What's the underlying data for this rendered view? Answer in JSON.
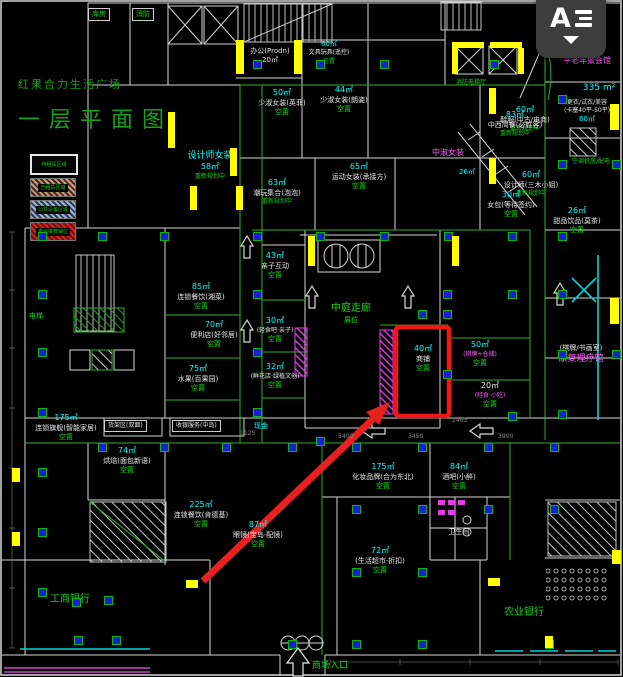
{
  "title": {
    "line1": "红果合力生活广场",
    "line2": "一层平面图"
  },
  "legend": {
    "items": [
      {
        "label": "待租赁区域",
        "swatch": "plain"
      },
      {
        "label": "已租赁区域",
        "swatch": "tan"
      },
      {
        "label": "公共设备区域",
        "swatch": "blue"
      },
      {
        "label": "重点推荐铺位",
        "swatch": "red"
      }
    ]
  },
  "watermark": {
    "label": "A",
    "caret": "dropdown"
  },
  "entrance": {
    "label": "商场入口"
  },
  "highlight": {
    "area": "40㎡",
    "name": "商铺",
    "status": "空置"
  },
  "colors": {
    "background": "#000000",
    "walls": "#dcdcdc",
    "rooms_green": "#2fae2f",
    "area_text": "#00ffff",
    "status_text": "#16d216",
    "special_text": "#ff5cff",
    "columns": "#1d1dd8",
    "wall_fill": "#ffff00",
    "highlight_red": "#f21616"
  },
  "plan": {
    "labels": [
      {
        "x": 88,
        "y": 8,
        "box": true,
        "lines": [
          {
            "t": "库房",
            "c": "gr",
            "s": 7
          }
        ]
      },
      {
        "x": 132,
        "y": 8,
        "box": true,
        "lines": [
          {
            "t": "消防",
            "c": "gr",
            "s": 7
          }
        ]
      },
      {
        "x": 240,
        "y": 47,
        "w": 60,
        "lines": [
          {
            "t": "办公(Prodn)",
            "c": "wh",
            "s": 7
          },
          {
            "t": "20㎡",
            "c": "wh",
            "s": 7
          }
        ]
      },
      {
        "x": 300,
        "y": 40,
        "w": 58,
        "lines": [
          {
            "t": "60㎡",
            "c": "cy",
            "s": 7
          },
          {
            "t": "文具玩具(遥控)",
            "c": "wh",
            "s": 6
          },
          {
            "t": "空置",
            "c": "gr",
            "s": 6
          }
        ]
      },
      {
        "x": 450,
        "y": 79,
        "w": 42,
        "lines": [
          {
            "t": "消防电梯厅",
            "c": "gr",
            "s": 6
          }
        ]
      },
      {
        "x": 540,
        "y": 22,
        "w": 72,
        "lines": [
          {
            "t": "75㎡ 设计师(预留)",
            "c": "wh",
            "s": 7
          }
        ]
      },
      {
        "x": 556,
        "y": 56,
        "w": 62,
        "lines": [
          {
            "t": "平老年聚会馆",
            "c": "mg",
            "s": 8
          }
        ]
      },
      {
        "x": 576,
        "y": 82,
        "w": 46,
        "lines": [
          {
            "t": "335 m²",
            "c": "cy",
            "s": 9
          }
        ]
      },
      {
        "x": 554,
        "y": 99,
        "w": 66,
        "lines": [
          {
            "t": "更衣/试衣/美容",
            "c": "wh",
            "s": 6
          },
          {
            "t": "(卡塞40平-50平)",
            "c": "wh",
            "s": 6
          },
          {
            "t": "60㎡",
            "c": "cy",
            "s": 7
          }
        ]
      },
      {
        "x": 562,
        "y": 158,
        "w": 58,
        "lines": [
          {
            "t": "空调机房/配电",
            "c": "gr",
            "s": 6
          }
        ]
      },
      {
        "x": 546,
        "y": 206,
        "w": 62,
        "lines": [
          {
            "t": "26㎡",
            "c": "cy",
            "s": 8
          },
          {
            "t": "甜品饮品(莫茶)",
            "c": "wh",
            "s": 7
          },
          {
            "t": "空置",
            "c": "gr",
            "s": 7
          }
        ]
      },
      {
        "x": 256,
        "y": 88,
        "w": 52,
        "lines": [
          {
            "t": "50㎡",
            "c": "cy",
            "s": 8
          },
          {
            "t": "少淑女装(英菲)",
            "c": "wh",
            "s": 7
          },
          {
            "t": "空置",
            "c": "gr",
            "s": 7
          }
        ]
      },
      {
        "x": 318,
        "y": 85,
        "w": 52,
        "lines": [
          {
            "t": "44㎡",
            "c": "cy",
            "s": 8
          },
          {
            "t": "少淑女装(朗姿)",
            "c": "wh",
            "s": 7
          },
          {
            "t": "空置",
            "c": "gr",
            "s": 7
          }
        ]
      },
      {
        "x": 494,
        "y": 105,
        "w": 62,
        "lines": [
          {
            "t": "60㎡",
            "c": "cy",
            "s": 8
          },
          {
            "t": "鞋服(中古/电商)",
            "c": "wh",
            "s": 7
          },
          {
            "t": "重新规划中",
            "c": "gr",
            "s": 6
          }
        ]
      },
      {
        "x": 246,
        "y": 178,
        "w": 62,
        "lines": [
          {
            "t": "63㎡",
            "c": "cy",
            "s": 8
          },
          {
            "t": "潮玩集合(泡泡)",
            "c": "wh",
            "s": 7
          },
          {
            "t": "重新规划中",
            "c": "gr",
            "s": 6
          }
        ]
      },
      {
        "x": 328,
        "y": 162,
        "w": 62,
        "lines": [
          {
            "t": "65㎡",
            "c": "cy",
            "s": 8
          },
          {
            "t": "运动女装(承接方)",
            "c": "wh",
            "s": 7
          },
          {
            "t": "空置",
            "c": "gr",
            "s": 7
          }
        ]
      },
      {
        "x": 496,
        "y": 170,
        "w": 70,
        "lines": [
          {
            "t": "60㎡",
            "c": "cy",
            "s": 8
          },
          {
            "t": "设计师(三木小姐)",
            "c": "wh",
            "s": 7
          },
          {
            "t": "重新规划中",
            "c": "gr",
            "s": 6
          }
        ]
      },
      {
        "x": 186,
        "y": 150,
        "w": 48,
        "lines": [
          {
            "t": "设计师女装",
            "c": "cy",
            "s": 9
          },
          {
            "t": "58㎡",
            "c": "cy",
            "s": 8
          },
          {
            "t": "重新规划中",
            "c": "gr",
            "s": 6
          }
        ]
      },
      {
        "x": 420,
        "y": 148,
        "w": 56,
        "lines": [
          {
            "t": "中淑女装",
            "c": "mg",
            "s": 8
          }
        ]
      },
      {
        "x": 452,
        "y": 168,
        "w": 30,
        "lines": [
          {
            "t": "26㎡",
            "c": "cy",
            "s": 7
          }
        ]
      },
      {
        "x": 480,
        "y": 190,
        "w": 62,
        "lines": [
          {
            "t": "30㎡",
            "c": "cy",
            "s": 8
          },
          {
            "t": "女包(等待签约)",
            "c": "wh",
            "s": 7
          },
          {
            "t": "空置",
            "c": "gr",
            "s": 7
          }
        ]
      },
      {
        "x": 484,
        "y": 110,
        "w": 62,
        "lines": [
          {
            "t": "83㎡",
            "c": "cy",
            "s": 8
          },
          {
            "t": "中西简餐(必胜客)",
            "c": "wh",
            "s": 7
          },
          {
            "t": "重新规划中",
            "c": "gr",
            "s": 6
          }
        ]
      },
      {
        "x": 252,
        "y": 251,
        "w": 46,
        "lines": [
          {
            "t": "43㎡",
            "c": "cy",
            "s": 8
          },
          {
            "t": "亲子互动",
            "c": "wh",
            "s": 7
          },
          {
            "t": "空置",
            "c": "gr",
            "s": 7
          }
        ]
      },
      {
        "x": 250,
        "y": 316,
        "w": 50,
        "lines": [
          {
            "t": "30㎡",
            "c": "cy",
            "s": 8
          },
          {
            "t": "(轻食吧·亲子)",
            "c": "wh",
            "s": 6
          },
          {
            "t": "空置",
            "c": "gr",
            "s": 7
          }
        ]
      },
      {
        "x": 246,
        "y": 362,
        "w": 58,
        "lines": [
          {
            "t": "32㎡",
            "c": "cy",
            "s": 8
          },
          {
            "t": "(鲜花店·绿植文创)",
            "c": "wh",
            "s": 6
          },
          {
            "t": "空置",
            "c": "gr",
            "s": 7
          }
        ]
      },
      {
        "x": 306,
        "y": 302,
        "w": 90,
        "lines": [
          {
            "t": "中庭走廊",
            "c": "gr",
            "s": 10
          },
          {
            "t": "展位",
            "c": "gr",
            "s": 7
          }
        ]
      },
      {
        "x": 400,
        "y": 344,
        "w": 46,
        "lines": [
          {
            "t": "40㎡",
            "c": "cy",
            "s": 8
          },
          {
            "t": "商铺",
            "c": "wh",
            "s": 7
          },
          {
            "t": "空置",
            "c": "gr",
            "s": 7
          }
        ]
      },
      {
        "x": 452,
        "y": 340,
        "w": 56,
        "lines": [
          {
            "t": "50㎡",
            "c": "cy",
            "s": 8
          },
          {
            "t": "(棋牌+仓储)",
            "c": "mg",
            "s": 6
          },
          {
            "t": "空置",
            "c": "gr",
            "s": 7
          }
        ]
      },
      {
        "x": 462,
        "y": 381,
        "w": 56,
        "lines": [
          {
            "t": "20㎡",
            "c": "wh",
            "s": 8
          },
          {
            "t": "(轻食·小吃)",
            "c": "mg",
            "s": 6
          },
          {
            "t": "空置",
            "c": "gr",
            "s": 7
          }
        ]
      },
      {
        "x": 544,
        "y": 344,
        "w": 74,
        "lines": [
          {
            "t": "(棋牌/书画室)",
            "c": "wh",
            "s": 7
          },
          {
            "t": "康复理疗馆",
            "c": "mg",
            "s": 9
          }
        ]
      },
      {
        "x": 166,
        "y": 282,
        "w": 70,
        "lines": [
          {
            "t": "85㎡",
            "c": "cy",
            "s": 8
          },
          {
            "t": "连锁餐饮(湘菜)",
            "c": "wh",
            "s": 7
          },
          {
            "t": "空置",
            "c": "gr",
            "s": 7
          }
        ]
      },
      {
        "x": 182,
        "y": 320,
        "w": 64,
        "lines": [
          {
            "t": "70㎡",
            "c": "cy",
            "s": 8
          },
          {
            "t": "便利店(好邻居)",
            "c": "wh",
            "s": 7
          },
          {
            "t": "空置",
            "c": "gr",
            "s": 7
          }
        ]
      },
      {
        "x": 168,
        "y": 364,
        "w": 60,
        "lines": [
          {
            "t": "75㎡",
            "c": "cy",
            "s": 8
          },
          {
            "t": "水果(百果园)",
            "c": "wh",
            "s": 7
          },
          {
            "t": "空置",
            "c": "gr",
            "s": 7
          }
        ]
      },
      {
        "x": 24,
        "y": 413,
        "w": 84,
        "lines": [
          {
            "t": "175㎡",
            "c": "cy",
            "s": 8
          },
          {
            "t": "连锁旗舰(智能家居)",
            "c": "wh",
            "s": 7
          },
          {
            "t": "空置",
            "c": "gr",
            "s": 7
          }
        ]
      },
      {
        "x": 20,
        "y": 312,
        "w": 32,
        "lines": [
          {
            "t": "电梯",
            "c": "gr",
            "s": 7
          }
        ]
      },
      {
        "x": 104,
        "y": 420,
        "box": true,
        "lines": [
          {
            "t": "货架区(双面)",
            "c": "wh",
            "s": 6
          }
        ]
      },
      {
        "x": 172,
        "y": 420,
        "box": true,
        "lines": [
          {
            "t": "收银服务(中岛)",
            "c": "wh",
            "s": 6
          }
        ]
      },
      {
        "x": 248,
        "y": 422,
        "w": 26,
        "lines": [
          {
            "t": "现金",
            "c": "cy",
            "s": 7
          }
        ]
      },
      {
        "x": 336,
        "y": 462,
        "w": 94,
        "lines": [
          {
            "t": "175㎡",
            "c": "cy",
            "s": 8
          },
          {
            "t": "化妆品牌(合为东北)",
            "c": "wh",
            "s": 7
          },
          {
            "t": "空置",
            "c": "gr",
            "s": 7
          }
        ]
      },
      {
        "x": 342,
        "y": 546,
        "w": 76,
        "lines": [
          {
            "t": "72㎡",
            "c": "cy",
            "s": 8
          },
          {
            "t": "(生活超市·折扣)",
            "c": "wh",
            "s": 7
          },
          {
            "t": "空置",
            "c": "gr",
            "s": 7
          }
        ]
      },
      {
        "x": 422,
        "y": 462,
        "w": 74,
        "lines": [
          {
            "t": "84㎡",
            "c": "cy",
            "s": 8
          },
          {
            "t": "酒吧(小醉)",
            "c": "wh",
            "s": 7
          },
          {
            "t": "空置",
            "c": "gr",
            "s": 7
          }
        ]
      },
      {
        "x": 438,
        "y": 528,
        "w": 42,
        "lines": [
          {
            "t": "卫生间",
            "c": "wh",
            "s": 7
          }
        ]
      },
      {
        "x": 96,
        "y": 446,
        "w": 62,
        "lines": [
          {
            "t": "74㎡",
            "c": "cy",
            "s": 8
          },
          {
            "t": "烘焙(面包新语)",
            "c": "wh",
            "s": 7
          },
          {
            "t": "空置",
            "c": "gr",
            "s": 7
          }
        ]
      },
      {
        "x": 164,
        "y": 500,
        "w": 74,
        "lines": [
          {
            "t": "225㎡",
            "c": "cy",
            "s": 8
          },
          {
            "t": "连锁餐饮(肯德基)",
            "c": "wh",
            "s": 7
          },
          {
            "t": "空置",
            "c": "gr",
            "s": 7
          }
        ]
      },
      {
        "x": 222,
        "y": 520,
        "w": 72,
        "lines": [
          {
            "t": "87㎡",
            "c": "cy",
            "s": 8
          },
          {
            "t": "眼镜(宝岛·配镜)",
            "c": "wh",
            "s": 7
          },
          {
            "t": "空置",
            "c": "gr",
            "s": 7
          }
        ]
      },
      {
        "x": 38,
        "y": 593,
        "w": 64,
        "lines": [
          {
            "t": "工商银行",
            "c": "gr",
            "s": 10
          }
        ]
      },
      {
        "x": 488,
        "y": 606,
        "w": 72,
        "lines": [
          {
            "t": "农业银行",
            "c": "gr",
            "s": 10
          }
        ]
      },
      {
        "x": 304,
        "y": 660,
        "w": 52,
        "lines": [
          {
            "t": "商场入口",
            "c": "gr",
            "s": 9
          }
        ]
      }
    ],
    "columns": [
      [
        253,
        60
      ],
      [
        316,
        60
      ],
      [
        380,
        60
      ],
      [
        490,
        60
      ],
      [
        253,
        232
      ],
      [
        316,
        232
      ],
      [
        380,
        232
      ],
      [
        444,
        232
      ],
      [
        508,
        232
      ],
      [
        253,
        290
      ],
      [
        253,
        348
      ],
      [
        253,
        408
      ],
      [
        443,
        290
      ],
      [
        443,
        310
      ],
      [
        443,
        370
      ],
      [
        508,
        290
      ],
      [
        508,
        412
      ],
      [
        558,
        95
      ],
      [
        558,
        160
      ],
      [
        558,
        232
      ],
      [
        558,
        290
      ],
      [
        558,
        350
      ],
      [
        558,
        410
      ],
      [
        612,
        160
      ],
      [
        612,
        350
      ],
      [
        38,
        232
      ],
      [
        38,
        290
      ],
      [
        38,
        348
      ],
      [
        38,
        408
      ],
      [
        38,
        468
      ],
      [
        38,
        528
      ],
      [
        38,
        588
      ],
      [
        98,
        232
      ],
      [
        160,
        232
      ],
      [
        98,
        443
      ],
      [
        160,
        443
      ],
      [
        222,
        443
      ],
      [
        288,
        443
      ],
      [
        352,
        443
      ],
      [
        418,
        443
      ],
      [
        484,
        443
      ],
      [
        550,
        443
      ],
      [
        352,
        505
      ],
      [
        418,
        505
      ],
      [
        484,
        505
      ],
      [
        550,
        505
      ],
      [
        352,
        568
      ],
      [
        418,
        568
      ],
      [
        72,
        598
      ],
      [
        104,
        596
      ],
      [
        74,
        636
      ],
      [
        112,
        636
      ],
      [
        288,
        640
      ],
      [
        352,
        640
      ],
      [
        418,
        640
      ],
      [
        545,
        640
      ],
      [
        418,
        310
      ],
      [
        316,
        437
      ]
    ],
    "yellow_marks": [
      [
        168,
        112,
        7,
        36
      ],
      [
        230,
        148,
        7,
        28
      ],
      [
        308,
        236,
        7,
        30
      ],
      [
        452,
        236,
        7,
        30
      ],
      [
        489,
        88,
        7,
        26
      ],
      [
        489,
        158,
        7,
        26
      ],
      [
        610,
        104,
        9,
        26
      ],
      [
        610,
        298,
        9,
        26
      ],
      [
        236,
        40,
        8,
        34
      ],
      [
        294,
        40,
        8,
        34
      ],
      [
        452,
        42,
        32,
        6
      ],
      [
        452,
        48,
        6,
        26
      ],
      [
        490,
        42,
        32,
        6
      ],
      [
        518,
        48,
        6,
        26
      ],
      [
        190,
        186,
        7,
        24
      ],
      [
        236,
        186,
        7,
        24
      ],
      [
        12,
        468,
        8,
        14
      ],
      [
        12,
        532,
        8,
        14
      ],
      [
        186,
        580,
        12,
        8
      ],
      [
        488,
        578,
        12,
        8
      ],
      [
        545,
        636,
        8,
        12
      ],
      [
        612,
        550,
        9,
        14
      ]
    ],
    "dim_labels": [
      {
        "x": 338,
        "y": 433,
        "t": "5400"
      },
      {
        "x": 408,
        "y": 433,
        "t": "3450"
      },
      {
        "x": 452,
        "y": 417,
        "t": "2463"
      },
      {
        "x": 498,
        "y": 433,
        "t": "3900"
      },
      {
        "x": 240,
        "y": 430,
        "t": "1125"
      }
    ]
  }
}
